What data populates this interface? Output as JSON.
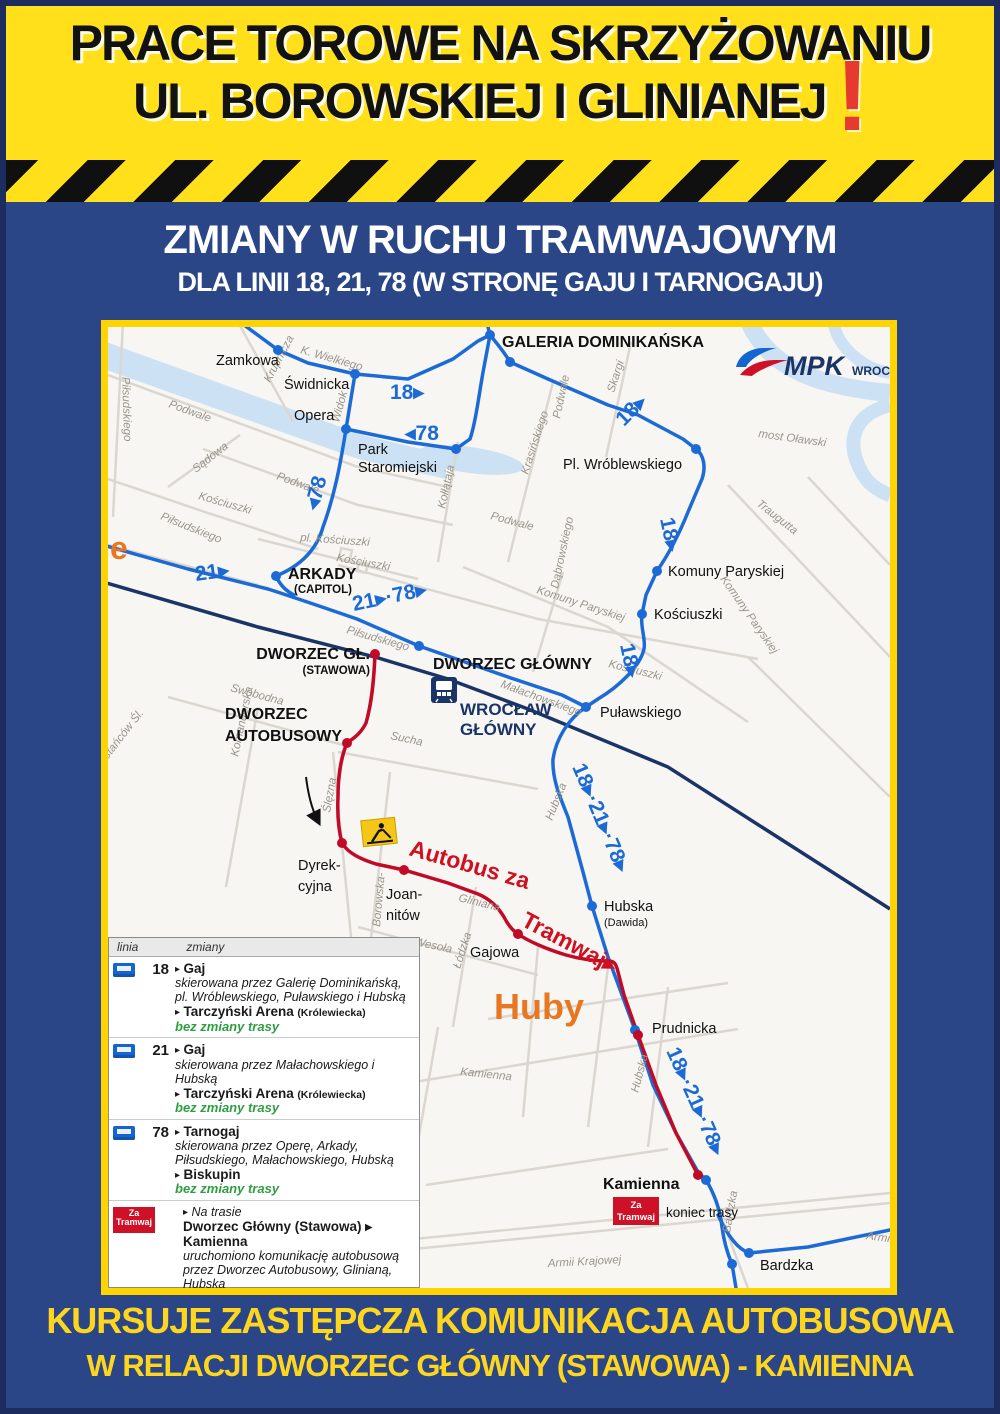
{
  "header": {
    "line1": "PRACE TOROWE NA SKRZYŻOWANIU",
    "line2": "UL. BOROWSKIEJ I GLINIANEJ",
    "exclamation": "!"
  },
  "subheader": {
    "line1": "ZMIANY W RUCHU TRAMWAJOWYM",
    "line2": "DLA LINII 18, 21, 78 (W STRONĘ GAJU I TARNOGAJU)"
  },
  "footer": {
    "line1": "KURSUJE ZASTĘPCZA KOMUNIKACJA AUTOBUSOWA",
    "line2": "W RELACJI DWORZEC GŁÓWNY (STAWOWA) - KAMIENNA"
  },
  "logo": {
    "mpk": "MPK",
    "city": "WROCŁAW"
  },
  "colors": {
    "yellow": "#FFE01A",
    "blue_bg": "#2B4687",
    "route_blue": "#1B6AD5",
    "route_red": "#C00A26",
    "rail_navy": "#1B3468",
    "water": "#CCE2F4",
    "note_green": "#2E9E41",
    "warning_red": "#D2232A"
  },
  "map": {
    "district_label": "Huby",
    "edge_label": "e",
    "badge_za_1": "Za",
    "badge_za_2": "Tramwaj",
    "koniec_trasy": "koniec trasy",
    "streets": [
      "Podwale",
      "Podwale",
      "Podwale",
      "Podwale",
      "Krupnicza",
      "Sądowa",
      "Piłsudskiego",
      "K. Wielkiego",
      "Widok",
      "Kołłątaja",
      "Skargi",
      "Krasińskiego",
      "Komuny Paryskiej",
      "Komuny Paryskiej",
      "Dąbrowskiego",
      "Traugutta",
      "most Oławski",
      "Kościuszki",
      "pl. Kościuszki",
      "Kościuszki",
      "Kościuszki",
      "Piłsudskiego",
      "Piłsudskiego",
      "Małachowskiego",
      "Swobodna",
      "Komandorska",
      "Powstańców Śl.",
      "Sucha",
      "Ślęzna",
      "Borowska-",
      "Gliniana",
      "Wesoła",
      "Łódzka",
      "Hubska",
      "Hubska",
      "Kamienna",
      "Armii Krajowej",
      "Bardzka",
      "Armii"
    ],
    "stops": {
      "zamkowa": "Zamkowa",
      "swidnicka": "Świdnicka",
      "opera": "Opera",
      "park_1": "Park",
      "park_2": "Staromiejski",
      "galeria": "GALERIA DOMINIKAŃSKA",
      "wroblewskiego": "Pl. Wróblewskiego",
      "komuny": "Komuny Paryskiej",
      "kosciuszki": "Kościuszki",
      "pulaskiego": "Puławskiego",
      "arkady": "ARKADY",
      "arkady_sub": "(CAPITOL)",
      "dworzec_gl": "DWORZEC GŁ.",
      "dworzec_gl_sub": "(STAWOWA)",
      "dworzec_glowny": "DWORZEC GŁÓWNY",
      "wroclaw_1": "WROCŁAW",
      "wroclaw_2": "GŁÓWNY",
      "autobusowy_1": "DWORZEC",
      "autobusowy_2": "AUTOBUSOWY",
      "dyrekcyjna_1": "Dyrek-",
      "dyrekcyjna_2": "cyjna",
      "joannitow_1": "Joan-",
      "joannitow_2": "nitów",
      "gajowa": "Gajowa",
      "hubska": "Hubska",
      "hubska_sub": "(Dawida)",
      "prudnicka": "Prudnicka",
      "kamienna": "Kamienna",
      "bardzka": "Bardzka"
    },
    "route_labels": {
      "l18": "18▸",
      "l78_h": "◂78",
      "l78_v": "◂78",
      "l21": "21▸",
      "l21_78": "21▸·78▸",
      "l18_diag": "18▸",
      "l18_v1": "18▸",
      "l18_v2": "18▸",
      "combo1": "18▸·21▸·78▸",
      "combo2": "18▸·21▸·78▸",
      "bus_1": "Autobus za",
      "bus_2": "Tramwaj▸"
    }
  },
  "legend": {
    "col_line": "linia",
    "col_changes": "zmiany",
    "arrow": "▸",
    "rows": [
      {
        "line": "18",
        "dest": "Gaj",
        "desc": "skierowana przez Galerię Dominikańską, pl. Wróblewskiego, Puławskiego i Hubską",
        "dest2": "Tarczyński Arena",
        "dest2_sub": "(Królewiecka)",
        "note": "bez zmiany trasy"
      },
      {
        "line": "21",
        "dest": "Gaj",
        "desc": "skierowana przez Małachowskiego i Hubską",
        "dest2": "Tarczyński Arena",
        "dest2_sub": "(Królewiecka)",
        "note": "bez zmiany trasy"
      },
      {
        "line": "78",
        "dest": "Tarnogaj",
        "desc": "skierowana przez Operę, Arkady, Piłsudskiego, Małachowskiego, Hubską",
        "dest2": "Biskupin",
        "dest2_sub": "",
        "note": "bez zmiany trasy"
      }
    ],
    "bus_row": {
      "badge_1": "Za",
      "badge_2": "Tramwaj",
      "title": "Na trasie",
      "route": "Dworzec Główny (Stawowa) ▸ Kamienna",
      "desc": "uruchomiono komunikację autobusową przez Dworzec Autobusowy, Glinianą, Hubską"
    },
    "warning_1": "Zmiany dotyczą tylko w kierunku Gaju i Tarnogaju!",
    "warning_2": "W kierunku Dworca i Centrum tramwaje",
    "warning_3": "kursują bez zmian!"
  }
}
